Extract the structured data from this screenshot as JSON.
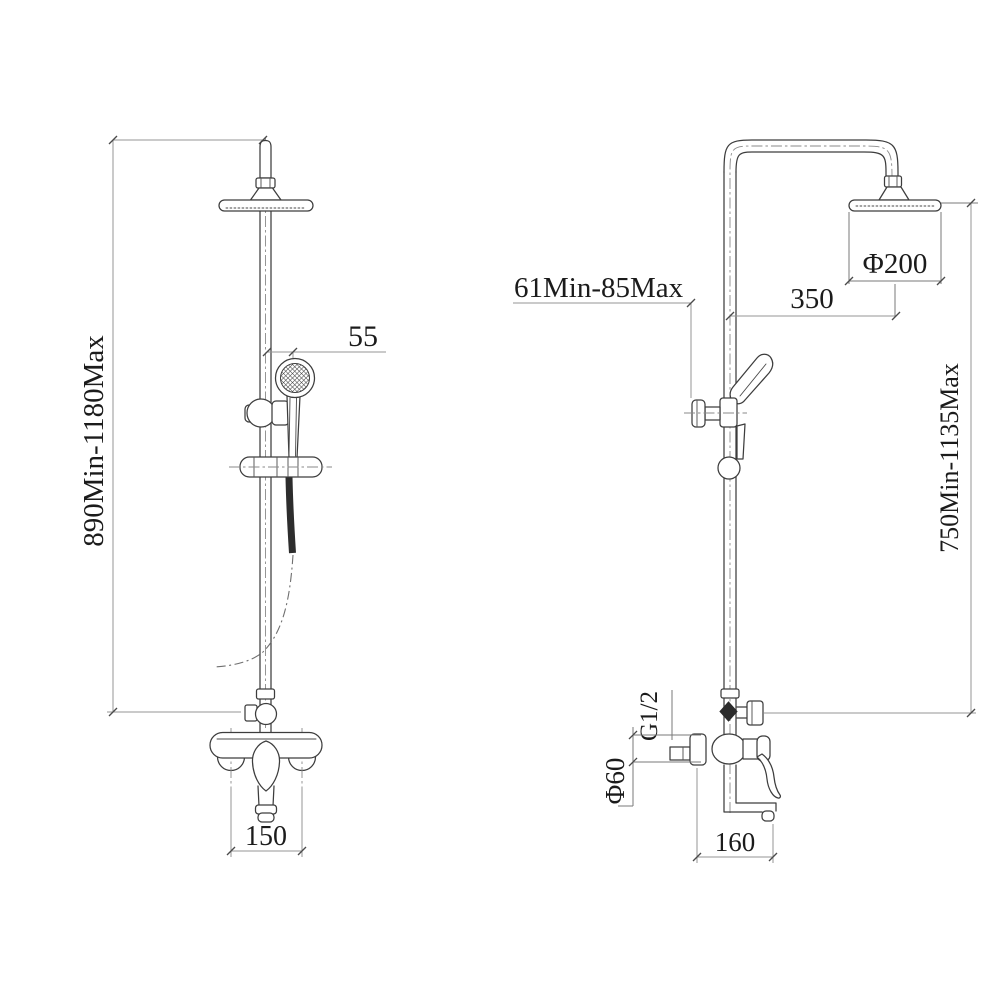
{
  "drawing": {
    "front_view": {
      "height_range": "890Min-1180Max",
      "hand_shower_offset": "55",
      "mount_hole_spacing": "150"
    },
    "side_view": {
      "head_diameter": "Φ200",
      "head_reach": "350",
      "bracket_range": "61Min-85Max",
      "height_range": "750Min-1135Max",
      "inlet_thread": "G1/2",
      "flange_diameter": "Φ60",
      "spout_reach": "160"
    },
    "colors": {
      "object_line": "#3d3d3d",
      "dimension_line": "#949494",
      "text": "#1b1b1b",
      "background": "#ffffff"
    }
  }
}
